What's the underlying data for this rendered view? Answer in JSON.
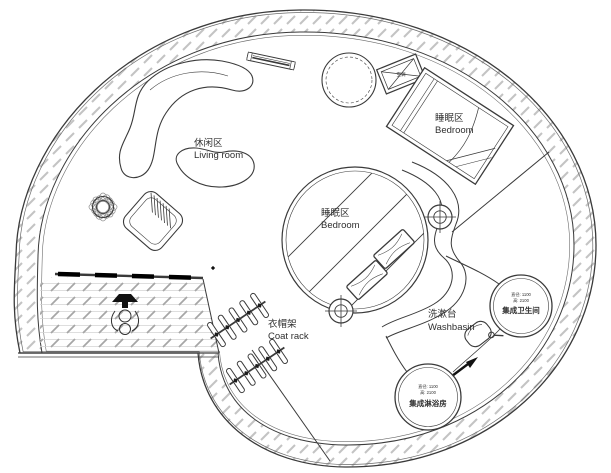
{
  "plan": {
    "type": "circular-house-floor-plan",
    "labels": {
      "living_room": {
        "zh": "休闲区",
        "en": "Living room"
      },
      "bedroom_loft": {
        "zh": "睡眠区",
        "en": "Bedroom"
      },
      "bedroom_center": {
        "zh": "睡眠区",
        "en": "Bedroom"
      },
      "coat_rack": {
        "zh": "衣帽架",
        "en": "Coat rack"
      },
      "washbasin": {
        "zh": "洗漱台",
        "en": "Washbasin"
      }
    },
    "pods": {
      "toilet": {
        "name": "集成卫生间",
        "diameter": "直径: 1100",
        "height": "高: 2100"
      },
      "shower": {
        "name": "集成淋浴房",
        "diameter": "直径: 1100",
        "height": "高: 2100"
      }
    },
    "equipment": {
      "ac_label": "空调"
    },
    "colors": {
      "line": "#3a3a3a",
      "hatch": "#bcbcbc",
      "tile": "#a6a6a6",
      "text": "#2f2f2f",
      "bg": "#ffffff"
    }
  }
}
